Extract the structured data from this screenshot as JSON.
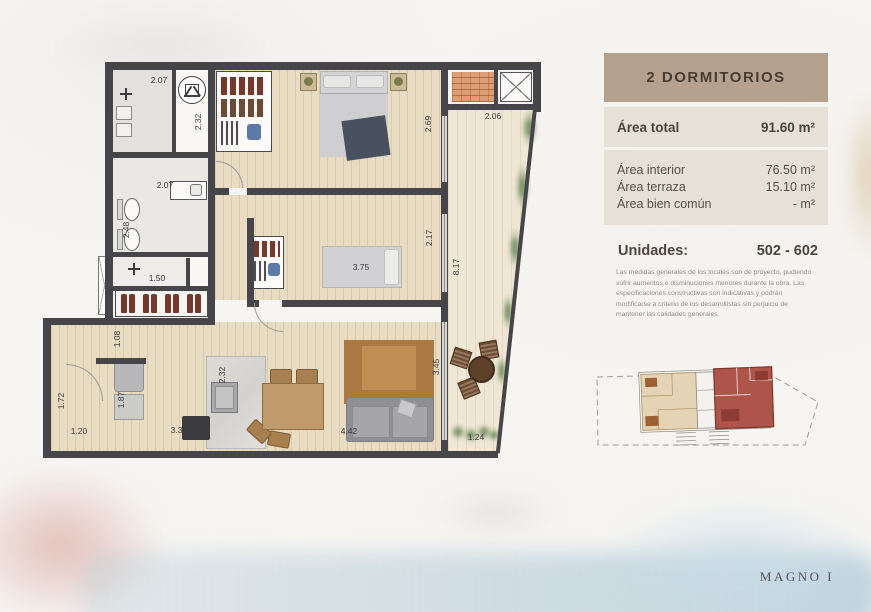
{
  "panel": {
    "title": "2 DORMITORIOS",
    "area_total": {
      "label": "Área total",
      "value": "91.60 m²"
    },
    "rows": [
      {
        "label": "Área interior",
        "value": "76.50 m²"
      },
      {
        "label": "Área terraza",
        "value": "15.10 m²"
      },
      {
        "label": "Área bien común",
        "value": "- m²"
      }
    ],
    "units": {
      "label": "Unidades:",
      "value": "502 - 602"
    },
    "disclaimer": "Las medidas generales de los locales son de proyecto, pudiendo sufrir aumentos o disminuciones menores durante la obra. Las especificaciones constructivas son indicativas y podrán modificarse a criterio de los desarrollistas sin perjuicio de mantener las calidades generales."
  },
  "plan": {
    "dims": {
      "laundry_w": "2.07",
      "shaft_h": "2.32",
      "bath_w": "2.07",
      "bath_h": "2.48",
      "closet_w": "1.50",
      "hall_w": "1.08",
      "entry_h": "1.72",
      "entry_w": "1.20",
      "kitchen_h": "1.87",
      "kitchen_w": "3.34",
      "island_h": "2.32",
      "bed2_w": "3.75",
      "bed2_h": "2.17",
      "bed1_h": "2.69",
      "terrace_w": "2.06",
      "terrace_h": "8.17",
      "living_h": "3.45",
      "living_w": "4.42",
      "terrace_b": "1.24"
    }
  },
  "brand": "MAGNO I",
  "colors": {
    "wall": "#46464a",
    "wood_floor": "#e8dcc2",
    "terrace_floor": "#efe6d3",
    "panel_header_bg": "#b4a28e",
    "panel_box_bg": "#e6e0d6",
    "keyplan_highlight": "#ae544b"
  },
  "icons": {
    "vent": "triangle-in-circle",
    "plumbing": "plus-cross",
    "shaft": "diagonal-box"
  }
}
